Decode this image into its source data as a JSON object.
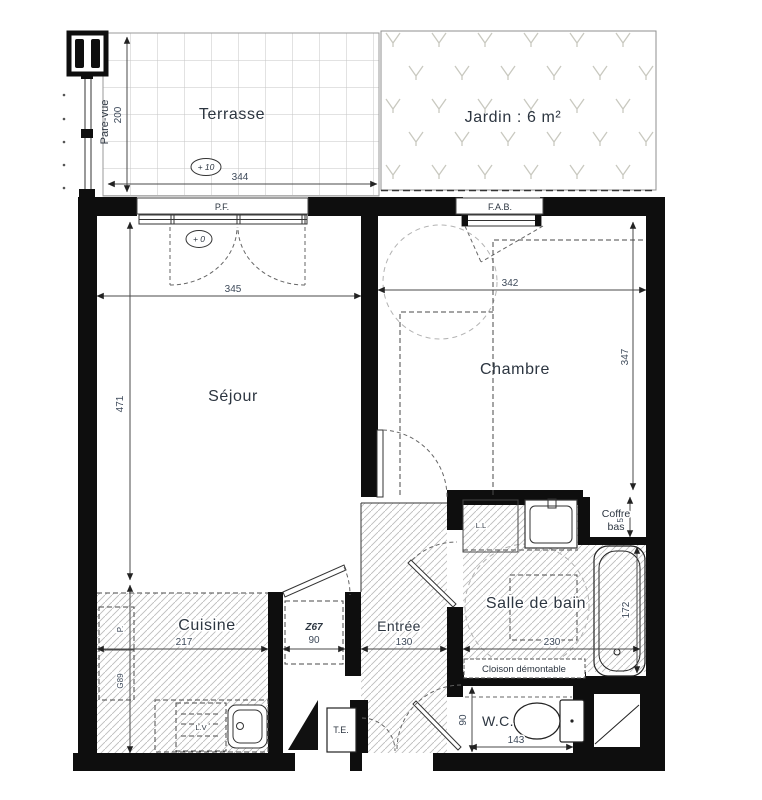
{
  "plan": {
    "rooms": {
      "terrasse": {
        "label": "Terrasse",
        "level": "+ 10"
      },
      "jardin": {
        "label": "Jardin : 6 m²"
      },
      "sejour": {
        "label": "Séjour",
        "level": "+ 0"
      },
      "chambre": {
        "label": "Chambre"
      },
      "cuisine": {
        "label": "Cuisine"
      },
      "entree": {
        "label": "Entrée"
      },
      "salle_de_bain": {
        "label": "Salle de bain",
        "cloison": "Cloison démontable",
        "coffre_line1": "Coffre",
        "coffre_line2": "bas",
        "washer": "L.L"
      },
      "wc": {
        "label": "W.C."
      },
      "placard": {
        "label": "Z67"
      }
    },
    "openings": {
      "pf": "P.F.",
      "fab": "F.A.B."
    },
    "annotations": {
      "pare_vue": "Pare-vue",
      "te": "T.E.",
      "lv": "L.V"
    },
    "dimensions": {
      "terrasse_w": "344",
      "terrasse_h": "200",
      "sejour_w": "345",
      "sejour_h": "471",
      "chambre_w": "342",
      "chambre_h": "347",
      "cuisine_w": "217",
      "cuisine_seg_a": "P.",
      "cuisine_seg_b": "G89",
      "placard_w": "90",
      "entree_w": "130",
      "sdb_w": "230",
      "bain_l": "172",
      "coffre_h": "51",
      "wc_w": "143",
      "wc_d": "90"
    }
  }
}
